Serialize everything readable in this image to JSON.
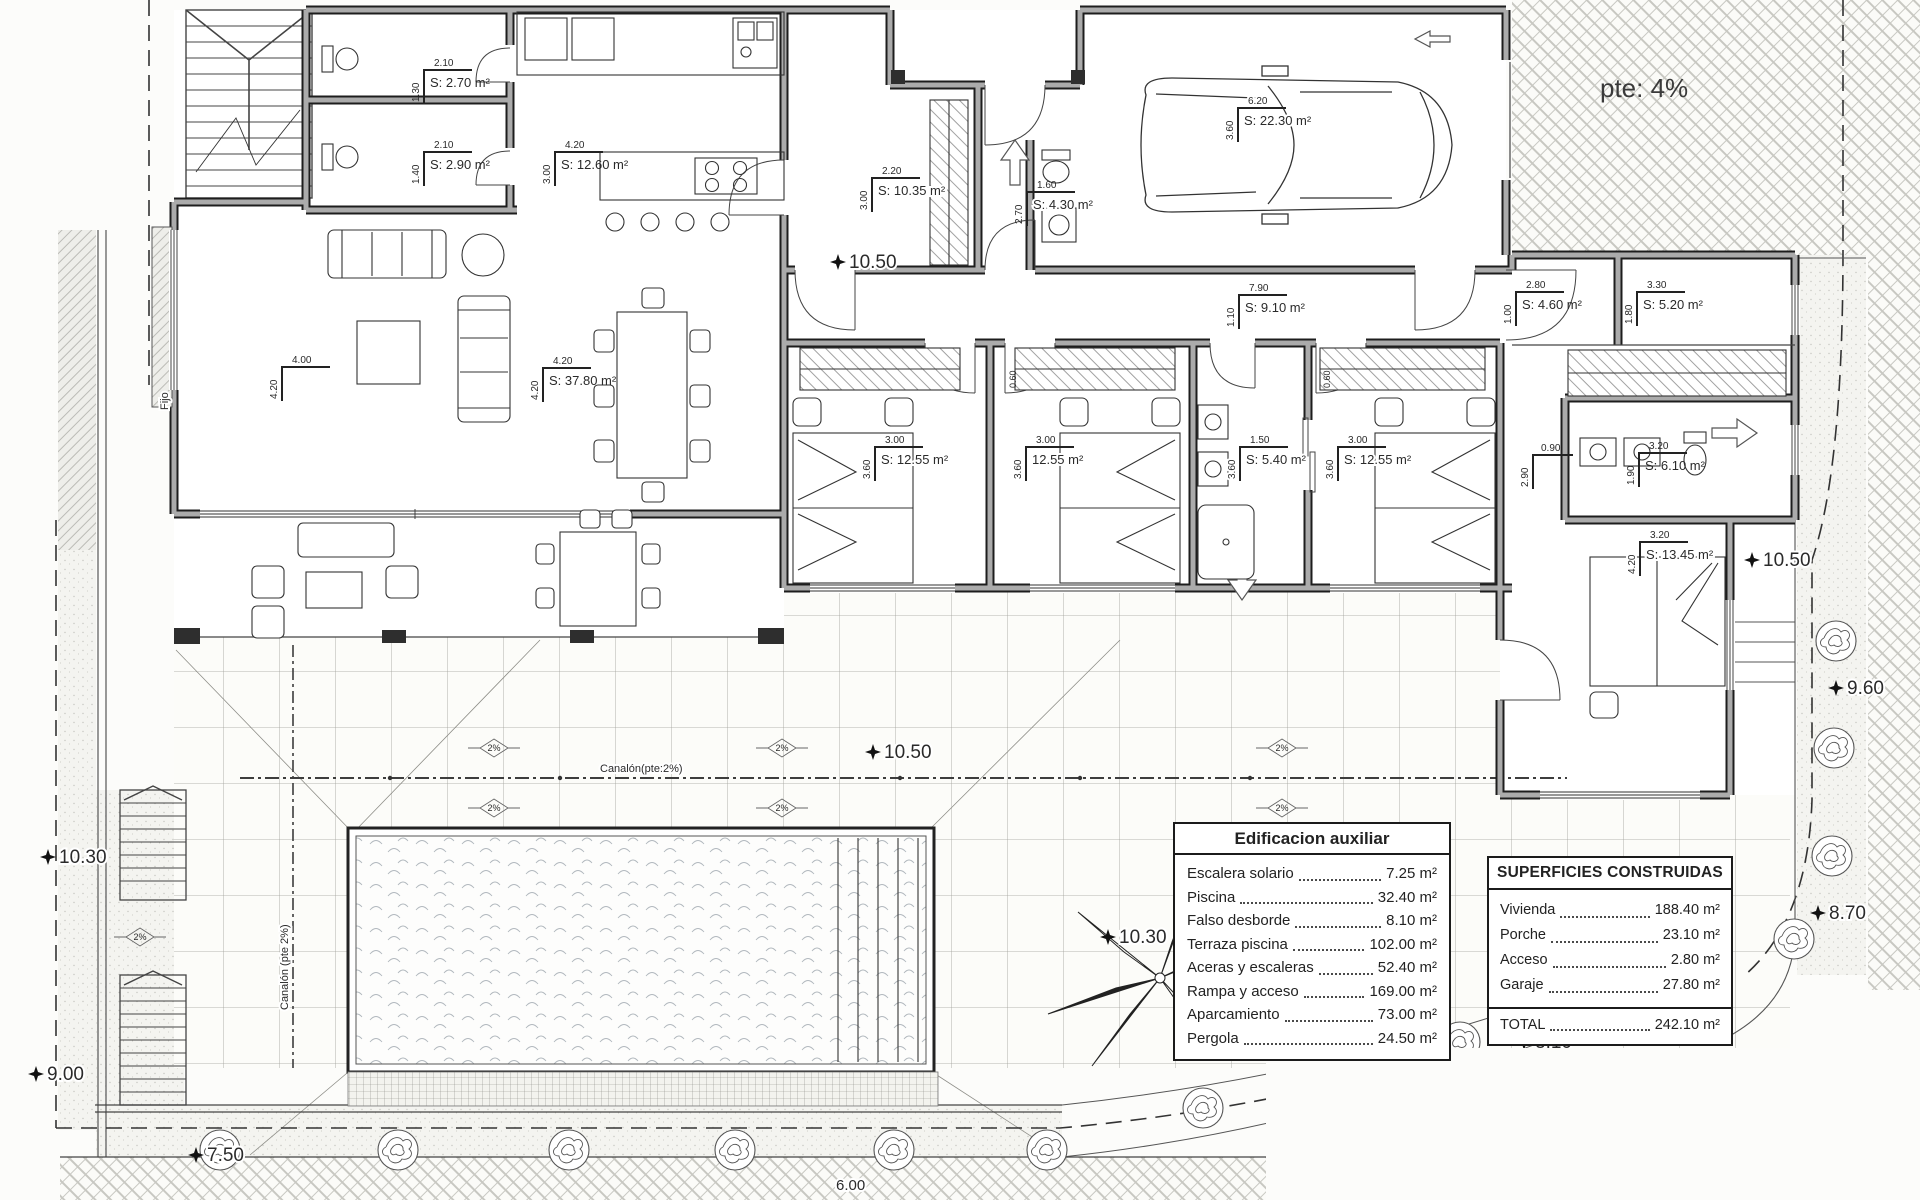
{
  "plan": {
    "slope_note": "pte: 4%",
    "slope_pct": "2%",
    "gutter_note_h": "Canalón(pte:2%)",
    "gutter_note_v": "Canalón (pte 2%)",
    "window_note": "Fijo",
    "bottom_dim": "6.00"
  },
  "rooms": [
    {
      "id": "aseo-1",
      "w": "2.10",
      "h": "1.30",
      "area": "S: 2.70 m²"
    },
    {
      "id": "aseo-2",
      "w": "2.10",
      "h": "1.40",
      "area": "S: 2.90 m²"
    },
    {
      "id": "cocina",
      "w": "4.20",
      "h": "3.00",
      "area": "S: 12.60 m²"
    },
    {
      "id": "salon",
      "w": "4.20",
      "h": "4.20",
      "area": "S: 37.80 m²"
    },
    {
      "id": "recibidor",
      "w": "2.20",
      "h": "3.00",
      "area": "S: 10.35 m²"
    },
    {
      "id": "lavadero",
      "w": "1.60",
      "h": "2.70",
      "area": "S: 4.30 m²"
    },
    {
      "id": "garaje",
      "w": "6.20",
      "h": "3.60",
      "area": "S: 22.30 m²"
    },
    {
      "id": "pasillo",
      "w": "7.90",
      "h": "1.10",
      "area": "S: 9.10 m²"
    },
    {
      "id": "dormitorio-1",
      "w": "3.00",
      "h": "3.60",
      "area": "S: 12.55 m²"
    },
    {
      "id": "dormitorio-2",
      "w": "3.00",
      "h": "3.60",
      "area": "12.55 m²"
    },
    {
      "id": "bano-1",
      "w": "1.50",
      "h": "3.60",
      "area": "S: 5.40 m²"
    },
    {
      "id": "dormitorio-3",
      "w": "3.00",
      "h": "3.60",
      "area": "S: 12.55 m²"
    },
    {
      "id": "vestibulo",
      "w": "2.80",
      "h": "1.00",
      "area": "S: 4.60 m²"
    },
    {
      "id": "vestidor",
      "w": "3.30",
      "h": "1.80",
      "area": "S: 5.20 m²"
    },
    {
      "id": "bano-principal",
      "w": "3.20",
      "h": "1.90",
      "area": "S: 6.10 m²"
    },
    {
      "id": "dormitorio-principal",
      "w": "3.20",
      "h": "4.20",
      "area": "S: 13.45 m²"
    }
  ],
  "dims": [
    {
      "id": "salon-izq",
      "w": "4.00",
      "h": "4.20"
    },
    {
      "id": "paso-suite",
      "w": "0.90",
      "h": "2.90"
    },
    {
      "id": "jamba-1",
      "v": "0.60"
    },
    {
      "id": "jamba-2",
      "v": "0.60"
    }
  ],
  "elevations": [
    {
      "value": "10.50"
    },
    {
      "value": "10.50"
    },
    {
      "value": "10.50"
    },
    {
      "value": "10.30"
    },
    {
      "value": "10.30"
    },
    {
      "value": "9.60"
    },
    {
      "value": "9.00"
    },
    {
      "value": "8.70"
    },
    {
      "value": "8.10"
    },
    {
      "value": "7.50"
    }
  ],
  "aux_table": {
    "title": "Edificacion auxiliar",
    "rows": [
      {
        "label": "Escalera solario",
        "value": "7.25 m²"
      },
      {
        "label": "Piscina",
        "value": "32.40 m²"
      },
      {
        "label": "Falso desborde",
        "value": "8.10 m²"
      },
      {
        "label": "Terraza piscina",
        "value": "102.00 m²"
      },
      {
        "label": "Aceras y escaleras",
        "value": "52.40 m²"
      },
      {
        "label": "Rampa y acceso",
        "value": "169.00 m²"
      },
      {
        "label": "Aparcamiento",
        "value": "73.00 m²"
      },
      {
        "label": "Pergola",
        "value": "24.50 m²"
      }
    ]
  },
  "built_table": {
    "title": "SUPERFICIES CONSTRUIDAS",
    "rows": [
      {
        "label": "Vivienda",
        "value": "188.40 m²"
      },
      {
        "label": "Porche",
        "value": "23.10 m²"
      },
      {
        "label": "Acceso",
        "value": "2.80 m²"
      },
      {
        "label": "Garaje",
        "value": "27.80 m²"
      }
    ],
    "total_label": "TOTAL",
    "total_value": "242.10 m²"
  }
}
